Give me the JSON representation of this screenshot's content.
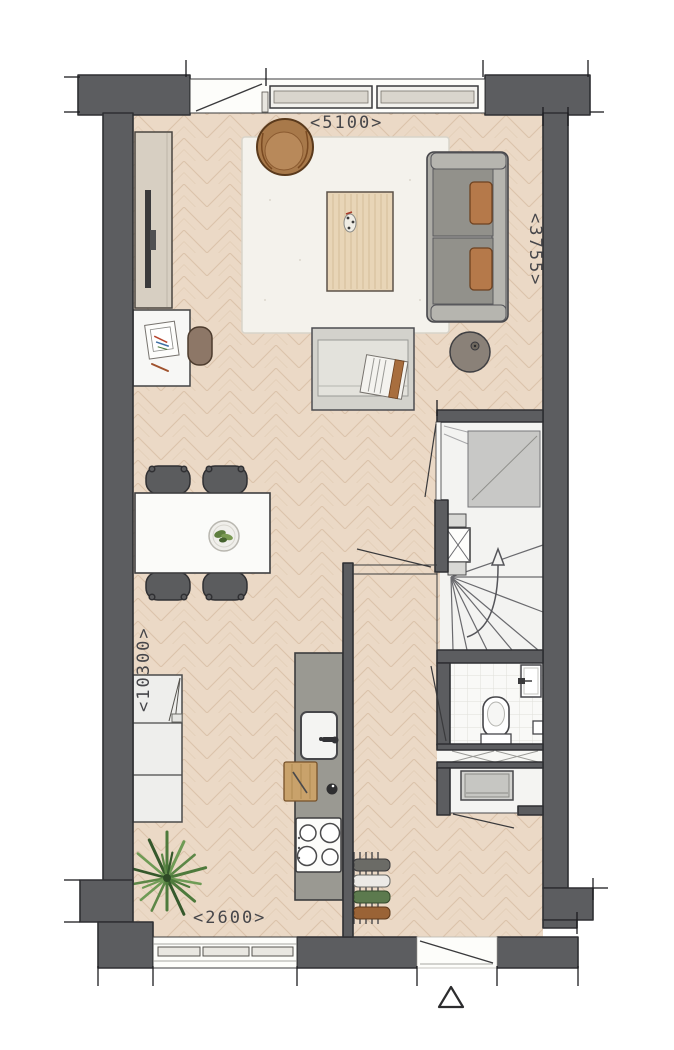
{
  "plan": {
    "type": "floor-plan",
    "dimensions": {
      "top": "<5100>",
      "right": "<3755>",
      "left": "<10300>",
      "bottom": "<2600>"
    },
    "colors": {
      "wall": "#5c5d60",
      "wall_outline": "#2e2f32",
      "floor": "#ebd9c6",
      "floor_line": "#c9a987",
      "rug": "#f4f2ec",
      "wood": "#e8d5b7",
      "sofa": "#acaba5",
      "cushion": "#b5794a",
      "counter": "#9a9992",
      "stair_floor": "#f3f3f1",
      "landing": "#c8c8c6",
      "plant": "#4e7a3c",
      "dim_text": "#46464a"
    },
    "rooms": [
      "living-room",
      "dining-area",
      "kitchen",
      "hall",
      "staircase",
      "toilet",
      "storage"
    ],
    "furniture": [
      "tv-cabinet",
      "tv",
      "desk",
      "desk-chair",
      "armchair",
      "rug",
      "sofa",
      "coffee-table",
      "daybed-bench",
      "side-table",
      "dining-table",
      "dining-chair",
      "fruit-bowl",
      "kitchen-cabinet",
      "kitchen-counter",
      "kitchen-sink",
      "cutting-board",
      "cooktop",
      "bottle-rack",
      "plant",
      "washing-machine",
      "toilet-bowl",
      "hand-basin",
      "meter-cupboard"
    ],
    "markers": {
      "entrance": "triangle",
      "stair_direction": "arrow-up"
    }
  }
}
